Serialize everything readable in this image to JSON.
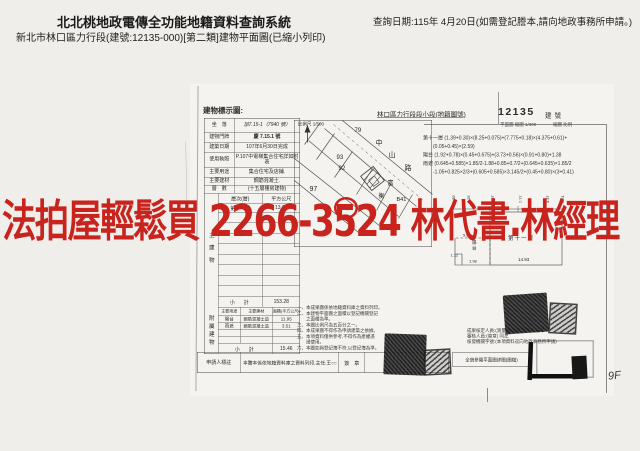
{
  "header": {
    "system_title": "北北桃地政電傳全功能地籍資料查詢系統",
    "subtitle": "新北市林口區力行段(建號:12135-000)[第二類]建物平面圖(已縮小列印)",
    "query_date": "查詢日期:115年 4月20日(如需登記謄本,請向地政事務所申請。)"
  },
  "watermark": {
    "text": "法拍屋輕鬆買 2266-3524 林代書.林經理",
    "color": "#c9231d"
  },
  "document": {
    "form_title": "建物標示圖:",
    "district_label": "林口區力行段段小段(地籍圖號)",
    "building_number": "12135",
    "building_number_label": "建號",
    "sub_note_left": "平面圖 縮圖 1/300",
    "sub_note_right": "縮圖 比例",
    "map": {
      "scale_label": "比例尺 1/500",
      "labels": [
        "79",
        "中",
        "93",
        "山",
        "92",
        "路",
        "97",
        "富",
        "衡",
        "B41",
        "37"
      ]
    },
    "calc_lines": [
      "第十一層 (1.39+0.30)×(8.25+0.075)+(7.775+0.18)×(4.375+0.61)+",
      "　　(0.05+0.45)×(2.59)",
      "陽台 (1.92+0.78)×(0.45+0.675)+(3.73+0.56)×(0.91+0.80)+1.38",
      "雨遮 (0.645+0.585)×1.85/2-1.88+0.85+0.7/2+(0.645+0.635)×1.85/2",
      "　　-1.05+0.825×2/3+(0.605+0.585)×3.145/2+(0.45+0.80)×(3+0.41)"
    ],
    "table": {
      "rows": [
        {
          "label": "坐　落",
          "value": "加7.15-1（7940 號）"
        },
        {
          "label": "建物門牌",
          "value": "慶 7.15.1 號"
        },
        {
          "label": "建築日期",
          "value": "107年6月30日完成"
        },
        {
          "label": "使用執照",
          "value": "P.107中電梯集合住宅詳如附表"
        },
        {
          "label": "主要用途",
          "value": "集合住宅及店鋪."
        },
        {
          "label": "主要建材",
          "value": "鋼筋混凝土."
        },
        {
          "label": "層　數",
          "value": "(十五層樓房建物)"
        }
      ],
      "floor_header": [
        "層次(層)",
        "平方公尺"
      ],
      "floor_row": [
        "第十一層",
        "13.91"
      ],
      "main_side_label": "主建物",
      "subtotal_label": "小　計",
      "main_subtotal": "153.28",
      "annex_side_label": "附屬建物",
      "annex_header": [
        "主要用途",
        "主要建材",
        "面積(平方公尺)"
      ],
      "annex_rows": [
        [
          "陽台",
          "鋼筋混凝土造",
          "11.95"
        ],
        [
          "雨遮",
          "鋼筋混凝土造",
          "3.51"
        ]
      ],
      "annex_subtotal": "15.46"
    },
    "legend_lines": [
      "一、本成果圖係依地籍資料庫之資料列印。",
      "二、本建物平面圖之面積以登記機關登記",
      "　　之面積為準。",
      "三、本圖比例尺為五百分之一。",
      "四、本成果圖不得作為申請建築之依據。",
      "五、本項資料僅供參考,不得作為產權憑",
      "　　證使用。",
      "六、本圖如與登記簿不符,以登記簿為準。"
    ],
    "plan": {
      "floor_label": "第十一層",
      "bottom_dim": "14.93",
      "balcony_label": "陽台",
      "dims": [
        "5.8",
        "1.98",
        "1.12"
      ],
      "top_dims": [
        "1.39",
        "8.25",
        "0.07",
        "7.77",
        "4.37",
        "0.61"
      ]
    },
    "officials_lines": [
      "成果核定人員:(測量員)測量課課長 核章",
      "審核人員:(簽章) 同左",
      "核發機關字號:(本項資料逕向地政事務所申請)"
    ],
    "bottom_row": {
      "label": "申請人標註",
      "text": "本謄本係依地籍資料庫之資料列印,主任:王○○ 承辦人:林○○",
      "sign_label": "簽　章",
      "side_note": "全貌參閱平面圖詳圖(圖檔)"
    },
    "page_mark": "9F"
  }
}
